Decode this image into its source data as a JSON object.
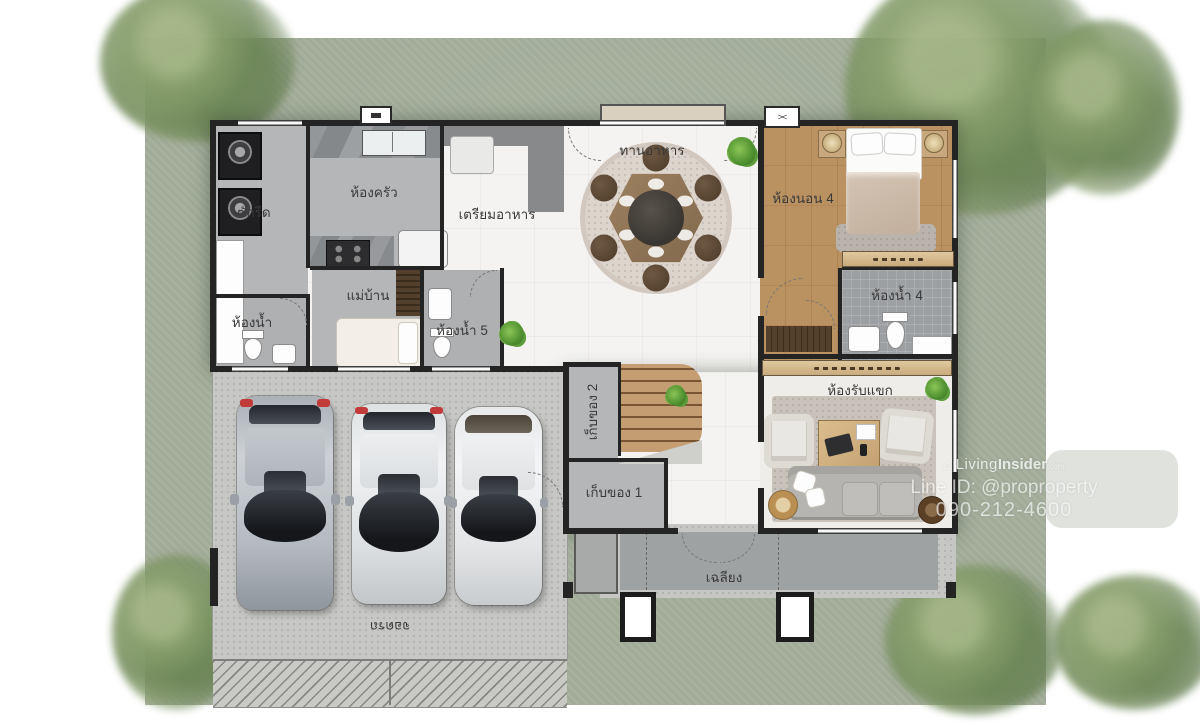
{
  "image": {
    "type": "floor-plan",
    "style": "single-storey Thai house plan, top-view architectural render"
  },
  "labels": {
    "laundry": "ซักรีด",
    "kitchen": "ห้องครัว",
    "food_prep": "เตรียมอาหาร",
    "dining": "ทานอาหาร",
    "bedroom4": "ห้องนอน 4",
    "bathroom4": "ห้องน้ำ 4",
    "maid": "แม่บ้าน",
    "bathroom": "ห้องน้ำ",
    "bathroom5": "ห้องน้ำ 5",
    "storage2": "เก็บของ 2",
    "storage1": "เก็บของ 1",
    "living": "ห้องรับแขก",
    "porch": "เฉลียง",
    "parking": "จอดรถ"
  },
  "watermark": {
    "brand_prefix": "Living",
    "brand_bold": "Insider",
    "brand_tld": ".com",
    "line_id": "Line ID: @proproperty",
    "phone": "090-212-4600"
  },
  "symbols": {
    "ac": "><"
  },
  "colors": {
    "lawn": "#a5af9c",
    "wall": "#242424",
    "service_floor": "#b4b6b8",
    "wood_floor": "#d8bf9b",
    "stairs_wood": "#c59d72",
    "concrete": "#c7c8c5",
    "watermark_text": "#ffffff"
  }
}
